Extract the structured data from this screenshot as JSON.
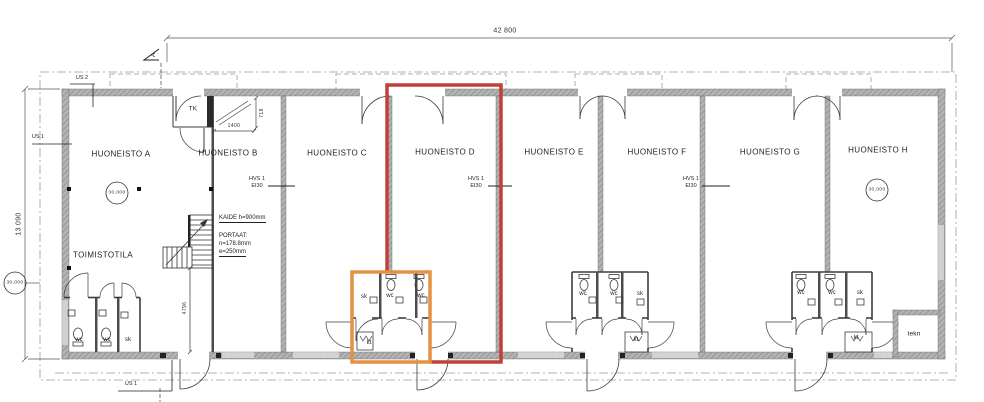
{
  "drawing_type": "architectural floor plan",
  "units": {
    "a": "HUONEISTO A",
    "b": "HUONEISTO B",
    "c": "HUONEISTO C",
    "d": "HUONEISTO D",
    "e": "HUONEISTO E",
    "f": "HUONEISTO F",
    "g": "HUONEISTO G",
    "h": "HUONEISTO H"
  },
  "areas": {
    "toimistotila": "TOIMISTOTILA",
    "tk": "TK",
    "tekn": "tekn",
    "wc": "wc",
    "sk": "sk",
    "kt": "kt"
  },
  "dimensions": {
    "overall_width": "42 800",
    "overall_height": "13 090",
    "stair_width": "1400",
    "stair_depth": "718",
    "bay_depth": "4796"
  },
  "grid": {
    "spacing_value": "30,000"
  },
  "wall_tags": {
    "hvs": "HVS 1",
    "ei": "EI30"
  },
  "exterior_wall_tags": {
    "us1": "US 1",
    "us2": "US 2"
  },
  "stair_notes": {
    "kaide": "KAIDE h=900mm",
    "portaat_title": "PORTAAT:",
    "riser": "n=178.8mm",
    "going": "e=250mm"
  },
  "section": {
    "label": "A"
  },
  "highlights": {
    "red": "#c0413a",
    "orange": "#e3923f"
  }
}
